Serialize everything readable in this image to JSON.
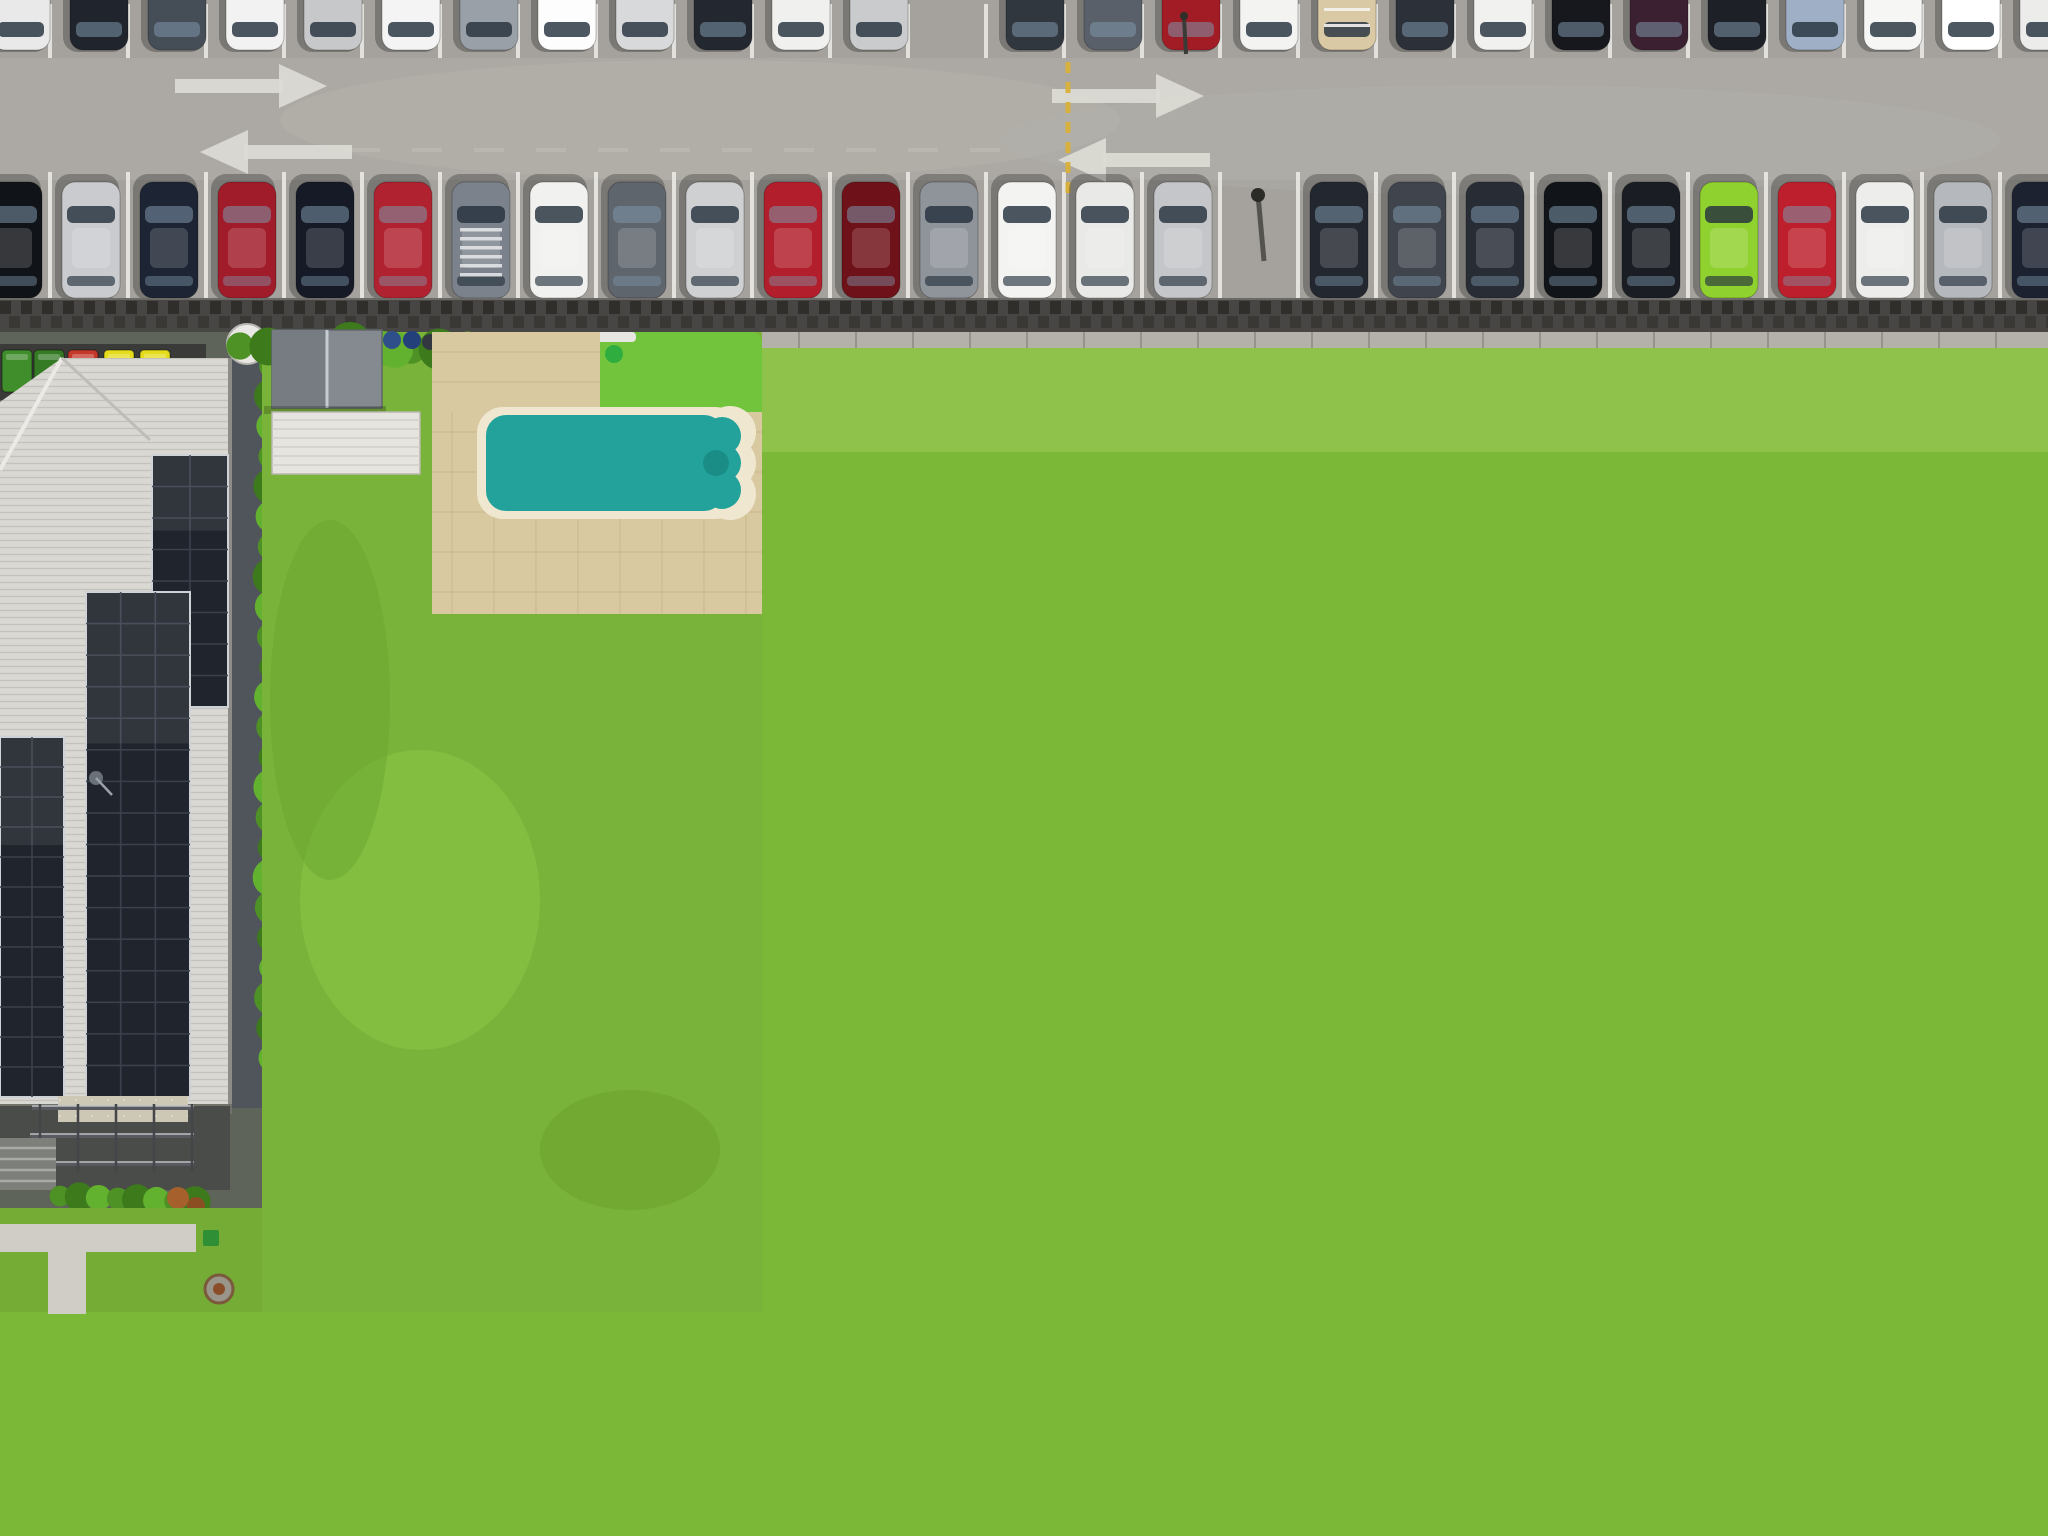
{
  "scene": {
    "type": "aerial-drone-real-estate-photo",
    "subject": "residential lot highlighted with orange boundary between neighbouring houses, car park above, street below",
    "width": 2048,
    "height": 1536
  },
  "highlight": {
    "color": "#F6A21B",
    "x": 757,
    "y": 309,
    "w": 449,
    "h": 993,
    "thickness": 13
  },
  "palette": {
    "asphalt": "#a5a29d",
    "asphaltLight": "#b2afa9",
    "bayLine": "#e8e7e3",
    "arrow": "#dcdbd5",
    "yellowLine": "#d8b13a",
    "railDark": "#474644",
    "railTie": "#2f2e2a",
    "railTie2": "#3a3834",
    "railCap": "#b4b1ab",
    "railCapJoint": "#96938c",
    "lawn": "#7bb838",
    "lawnBright": "#86c53f",
    "lawnLight": "#9ccf52",
    "lawnDark": "#639d2b",
    "turf": "#72c43c",
    "hedge1": "#4e9226",
    "hedge2": "#3c7a1b",
    "hedge3": "#63b22f",
    "hedgeDark": "#2d5a12",
    "tree1": "#417f1d",
    "tree2": "#58a328",
    "tree3": "#6cba35",
    "treeDark": "#35701a",
    "treeShadow": "#2c5414",
    "roofA": "#dad8d2",
    "roofB": "#d8d6d1",
    "roofBLow": "#e0deda",
    "roofC": "#cbd0d3",
    "roofCDark": "#b7bdc2",
    "roofCLight": "#d7dcde",
    "roofE": "#cdc7c0",
    "roofELight": "#d9d4cd",
    "ridgeWhite": "#eef1f2",
    "shedGray": "#848a90",
    "shedWhite": "#e6e4df",
    "shedWhiteD": "#efede7",
    "shedBrown": "#96675c",
    "shedTanE": "#d9c398",
    "shedGrayE": "#9fa5a9",
    "shedWhiteC": "#edebe7",
    "solarDark": "#20242c",
    "solarDarkLine": "#3a414d",
    "solarBlue": "#2d5b96",
    "solarBlueLine": "#1d406e",
    "solarFrame": "#cdd1d6",
    "poolTeal": "#22a29a",
    "poolTealLight": "#45bdb2",
    "poolTealDark": "#17857f",
    "coping": "#efe7d0",
    "poolBlue": "#1b9bd6",
    "poolBlueLight": "#3fb2e4",
    "poolBlueDark": "#0f6fa5",
    "poolLip": "#123c52",
    "copingC": "#f2efe6",
    "kidOuter": "#c8e7ee",
    "kidPink": "#e29cc6",
    "kidInner": "#8fd0e8",
    "deckTan": "#d9c9a0",
    "deckGrout": "#c4b084",
    "deckC": "#e9e5d8",
    "gravel": "#dedbd2",
    "gravelWhite": "#e8e6df",
    "pebble": "#d5d1c6",
    "mulch": "#7a5a40",
    "terracotta": "#e2a967",
    "terraLight": "#f0c489",
    "terraRidge": "#b5763a",
    "terraCap": "#e8b97e",
    "patio": "#d8cfba",
    "patioLine": "#c4b99f",
    "driveC": "#d7cfbb",
    "driveB": "#cdc3aa",
    "diamond": "#b9ad92",
    "driveD": "#d3b286",
    "driveDLine": "#bf9c6b",
    "driveE": "#d7d1c3",
    "sidewalk": "#d9b97e",
    "sidewalkJoint": "#c19e5f",
    "sidewalkOrange": "#d9a25f",
    "sidewalkPale": "#dcc79a",
    "road": "#97958f",
    "roadLight": "#a3a09a",
    "gutter": "#bcb9b3",
    "curb": "#d9d7d2",
    "roadPatch": "#807e79",
    "roadShadow": "#54544e",
    "pergola": "#352b23",
    "pergolaLine": "#1f1813",
    "rust": "#6e4a2e",
    "binGreen": "#3f8d2b",
    "binGreen2": "#357a24",
    "binRed": "#c5392b",
    "binYellow": "#e5dc1c",
    "binBlue": "#2f4f8a",
    "lounger": "#c9bd9e",
    "loungerLine": "#b3a784",
    "dish": "#e9e8e4",
    "dishDark": "#4a4f54",
    "heater": "#b9bfc4",
    "skylight": "#3a4148",
    "shadow": "rgba(0,0,0,0.30)",
    "shade": "rgba(45,83,21,0.5)"
  },
  "parking_lot": {
    "bay_line_color": "#e8e7e3",
    "lane_arrows": [
      {
        "x": 175,
        "y": 86,
        "dir": "right"
      },
      {
        "x": 200,
        "y": 152,
        "dir": "left"
      },
      {
        "x": 1052,
        "y": 96,
        "dir": "right"
      },
      {
        "x": 1058,
        "y": 160,
        "dir": "left"
      }
    ],
    "divider_line": {
      "x": 1068,
      "y1": 62,
      "y2": 188,
      "color": "#d8b13a",
      "style": "dashed"
    },
    "top_row_cars": [
      {
        "x": -8,
        "color": "#e9e9e9"
      },
      {
        "x": 70,
        "color": "#20242c"
      },
      {
        "x": 148,
        "color": "#454d57"
      },
      {
        "x": 226,
        "color": "#f2f2f2"
      },
      {
        "x": 304,
        "color": "#c6c8ca"
      },
      {
        "x": 382,
        "color": "#f4f4f4"
      },
      {
        "x": 460,
        "color": "#99a0a8"
      },
      {
        "x": 538,
        "color": "#fdfdfd"
      },
      {
        "x": 616,
        "color": "#d8d9da"
      },
      {
        "x": 694,
        "color": "#23272f"
      },
      {
        "x": 772,
        "color": "#f0f0ef"
      },
      {
        "x": 850,
        "color": "#c9cbcd"
      },
      null,
      {
        "x": 1006,
        "color": "#31373f"
      },
      {
        "x": 1084,
        "color": "#596069"
      },
      {
        "x": 1162,
        "color": "#a21c26"
      },
      {
        "x": 1240,
        "color": "#f3f3f2"
      },
      {
        "x": 1318,
        "color": "#d9caa5",
        "roof": "racks"
      },
      {
        "x": 1396,
        "color": "#2b3039"
      },
      {
        "x": 1474,
        "color": "#f1f1f0"
      },
      {
        "x": 1552,
        "color": "#16181d"
      },
      {
        "x": 1630,
        "color": "#3a2030"
      },
      {
        "x": 1708,
        "color": "#1d2127"
      },
      {
        "x": 1786,
        "color": "#9fb0c6"
      },
      {
        "x": 1864,
        "color": "#f6f6f5"
      },
      {
        "x": 1942,
        "color": "#ffffff"
      },
      {
        "x": 2020,
        "color": "#ececeb"
      }
    ],
    "bottom_row_cars": [
      {
        "x": -16,
        "color": "#101317"
      },
      {
        "x": 62,
        "color": "#c9cbce"
      },
      {
        "x": 140,
        "color": "#1d2433"
      },
      {
        "x": 218,
        "color": "#a11c2a"
      },
      {
        "x": 296,
        "color": "#151a26"
      },
      {
        "x": 374,
        "color": "#b02230"
      },
      {
        "x": 452,
        "color": "#7b828c",
        "roof": "louvers"
      },
      {
        "x": 530,
        "color": "#f1f1ef"
      },
      {
        "x": 608,
        "color": "#5f656d"
      },
      {
        "x": 686,
        "color": "#ced0d2"
      },
      {
        "x": 764,
        "color": "#b21e2b"
      },
      {
        "x": 842,
        "color": "#6e1119"
      },
      {
        "x": 920,
        "color": "#8f939a"
      },
      {
        "x": 998,
        "color": "#f3f3f2"
      },
      {
        "x": 1076,
        "color": "#e9e9e8"
      },
      {
        "x": 1154,
        "color": "#c4c6c9"
      },
      null,
      {
        "x": 1310,
        "color": "#23272f"
      },
      {
        "x": 1388,
        "color": "#3f444d"
      },
      {
        "x": 1466,
        "color": "#272c35"
      },
      {
        "x": 1544,
        "color": "#111419"
      },
      {
        "x": 1622,
        "color": "#1a1e24"
      },
      {
        "x": 1700,
        "color": "#8fd12e"
      },
      {
        "x": 1778,
        "color": "#bd1f2d"
      },
      {
        "x": 1856,
        "color": "#ededec"
      },
      {
        "x": 1934,
        "color": "#b5b8bc"
      },
      {
        "x": 2012,
        "color": "#1c2230"
      }
    ],
    "lamp_post": {
      "x": 1258,
      "y": 195
    }
  },
  "properties": {
    "left_building": {
      "roof": "#dad8d2",
      "solar": "#20242c",
      "bins": [
        "#3f8d2b",
        "#357a24",
        "#c5392b",
        "#e5dc1c",
        "#e5dc1c"
      ],
      "has_satellite_dish": true
    },
    "neighbor_left": {
      "roof": "#d8d6d1",
      "pool": "#22a29a",
      "deck": "#d9c9a0",
      "solar_columns": 4,
      "turf": "#72c43c",
      "sheds": [
        "#848a90",
        "#e6e4df"
      ],
      "driveway": "diamond-stamped-concrete"
    },
    "highlighted": {
      "boundary": "#F6A21B",
      "roof": "#cbd0d3",
      "pool": "#1b9bd6",
      "kiddie_pool": [
        "#c8e7ee",
        "#e29cc6",
        "#8fd0e8"
      ],
      "loungers": 2,
      "sheds": [
        "#edebe7",
        "#96675c"
      ],
      "pergola": "#352b23",
      "solar_arrays": 3,
      "hot_water_unit": true,
      "gazebo": true
    },
    "neighbor_right": {
      "roof": "#e2a967",
      "roof_type": "terracotta-tile",
      "shed": "#efede7",
      "garden_bed": "white-gravel",
      "driveway": "brick-pavers",
      "has_satellite_dish": true
    },
    "far_right": {
      "roof": "#cdc7c0",
      "sheds": [
        "#d9c398",
        "#9fa5a9"
      ],
      "has_satellite_dish": true,
      "solar": "#20262e",
      "palm_tree": true,
      "driveway": "#d7d1c3"
    }
  },
  "vegetation": {
    "street_trees": [
      {
        "x": 60,
        "y": 1505,
        "r": 85
      },
      {
        "x": 560,
        "y": 1345,
        "r": 50
      },
      {
        "x": 765,
        "y": 1372,
        "r": 76
      },
      {
        "x": 800,
        "y": 1212,
        "r": 58
      },
      {
        "x": 1155,
        "y": 1275,
        "r": 92
      },
      {
        "x": 1612,
        "y": 1368,
        "r": 70
      }
    ],
    "corner_trees": [
      {
        "x": 1952,
        "y": 1308,
        "r": 82
      },
      {
        "x": 2035,
        "y": 1430,
        "r": 88
      },
      {
        "x": 1868,
        "y": 1465,
        "r": 68
      },
      {
        "x": 1755,
        "y": 1523,
        "r": 55
      }
    ],
    "back_trees_right": [
      {
        "x": 1716,
        "y": 352,
        "r": 40
      },
      {
        "x": 1788,
        "y": 330,
        "r": 46
      },
      {
        "x": 1852,
        "y": 372,
        "r": 34
      },
      {
        "x": 1690,
        "y": 420,
        "r": 30
      },
      {
        "x": 1648,
        "y": 340,
        "r": 38
      },
      {
        "x": 1672,
        "y": 462,
        "r": 26
      }
    ],
    "parking_edge_trees": [
      {
        "x": 1800,
        "y": 312,
        "r": 24
      },
      {
        "x": 1862,
        "y": 326,
        "r": 28
      },
      {
        "x": 1930,
        "y": 314,
        "r": 22
      },
      {
        "x": 2000,
        "y": 328,
        "r": 26
      },
      {
        "x": 2044,
        "y": 306,
        "r": 18
      }
    ]
  }
}
